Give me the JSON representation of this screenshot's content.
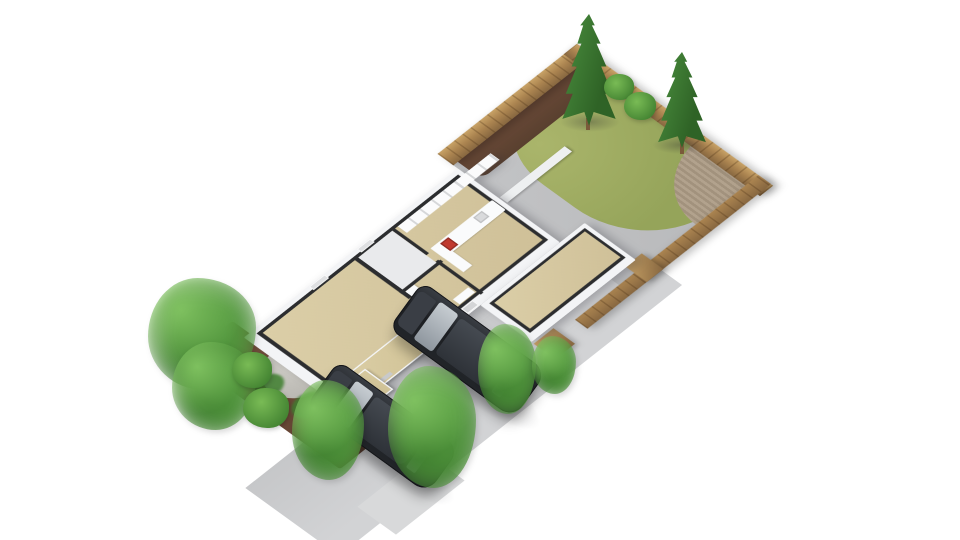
{
  "scene": {
    "title": "3D floor plan rendering",
    "description": "Isometric 3D cutaway floor plan of a single-story house with open rooftops showing interior rooms, a front driveway with two parked dark SUVs, landscaped mulch bed with shrubs, and a fenced back garden with lawn, planting strip, conifer trees, patio and a wooden deck",
    "background": "#ffffff",
    "projection": "axonometric, viewed from the front-left"
  },
  "colors": {
    "drive": "#c6c7c9",
    "drive2": "#d2d3d5",
    "sidewalk": "#d8d9da",
    "mulch": "#7a5440",
    "mulch2": "#5a3d2e",
    "gravel": "#cbc9c3",
    "patio": "#b7b8ba",
    "lawn": "#95a45a",
    "lawn2": "#aab56b",
    "gmulch": "#59402f",
    "wood": "#ab8450",
    "wood2": "#876740",
    "woodlight": "#c8a266",
    "deck": "#b2a28d",
    "deck2": "#a2927d",
    "wall": "#f3f4f6",
    "walltop": "#2c2d2f",
    "floor": "#cfc098",
    "floor2": "#dbcea7",
    "pale": "#e9eaec",
    "lowwall": "#eef0f1",
    "stove": "#c0392f",
    "glass": "#8e969e",
    "car": "#222529",
    "carroof": "#2e3238",
    "leaf1": "#7ec05f",
    "leaf2": "#54993f",
    "leaf3": "#3f7f2f",
    "conif": "#4c9140",
    "conif2": "#2f6326",
    "plantbright": "#79bb55"
  },
  "house": {
    "rooms": [
      {
        "name": "living-room",
        "floor": "beige"
      },
      {
        "name": "bedroom",
        "floor": "pale-grey"
      },
      {
        "name": "hallway",
        "floor": "beige"
      },
      {
        "name": "bathroom",
        "floor": "beige",
        "fixtures": [
          "closet",
          "washbasin"
        ]
      },
      {
        "name": "kitchen",
        "floor": "beige",
        "fixtures": [
          "wall-units",
          "counter",
          "red-stove",
          "sink"
        ]
      },
      {
        "name": "garden-studio",
        "floor": "beige",
        "detached": true
      }
    ],
    "features": [
      "front-door",
      "front-windows",
      "rear-windows",
      "roofed-porch-with-flat-beige-roof",
      "bay-extension"
    ]
  },
  "garden": {
    "elements": [
      "lawn",
      "mulch-planting-strip",
      "two-shrubs",
      "two-conifer-trees",
      "wooden-deck-quarter-circle",
      "timber-fence-three-sides",
      "concrete-patio-path",
      "low-white-garden-wall",
      "timber-gate"
    ]
  },
  "front_yard": {
    "elements": [
      "concrete-driveway",
      "sidewalk",
      "mulch-bed",
      "gravel-circle",
      "large-leafy-tree",
      "small-shrubs",
      "three-driveway-shrubs"
    ]
  },
  "vehicles": [
    {
      "name": "car-1",
      "type": "dark SUV",
      "position": "front parking spot, lower left"
    },
    {
      "name": "car-2",
      "type": "dark SUV",
      "position": "rear parking spot, upper right"
    }
  ]
}
